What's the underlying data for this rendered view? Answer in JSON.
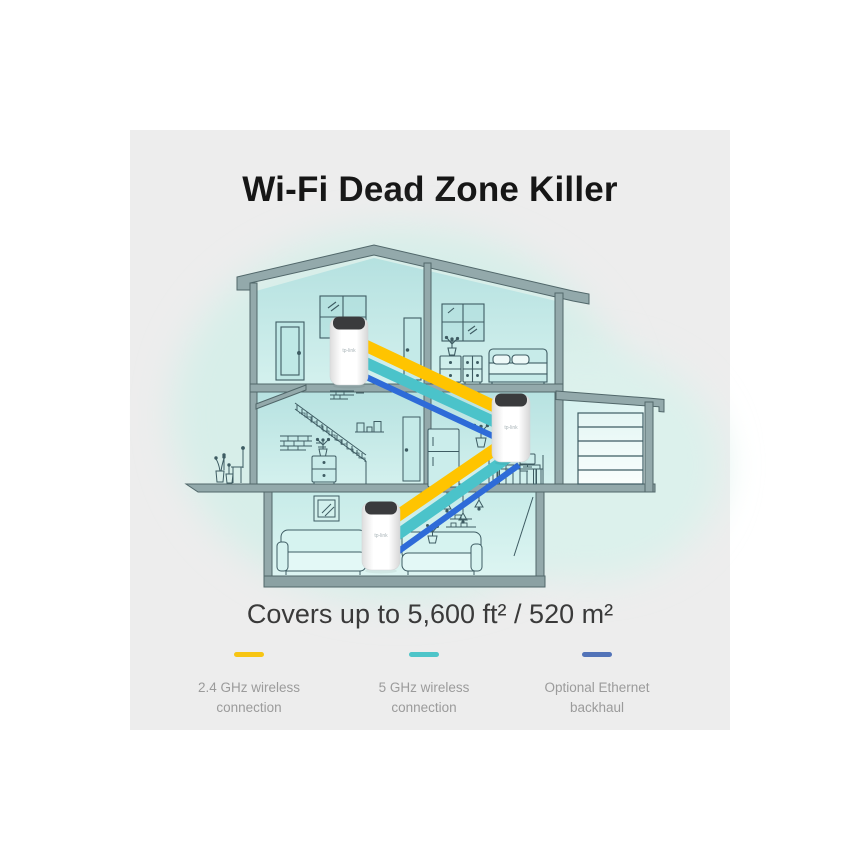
{
  "page": {
    "title": "Wi-Fi Dead Zone Killer",
    "coverage": "Covers up to 5,600 ft² / 520 m²"
  },
  "legend": {
    "items": [
      {
        "id": "wireless-24ghz",
        "line1": "2.4 GHz wireless",
        "line2": "connection",
        "color": "#F7C513"
      },
      {
        "id": "wireless-5ghz",
        "line1": "5 GHz wireless",
        "line2": "connection",
        "color": "#4EC5C9"
      },
      {
        "id": "ethernet-backhaul",
        "line1": "Optional Ethernet",
        "line2": "backhaul",
        "color": "#5273B8"
      }
    ]
  },
  "illustration": {
    "unit_logo": "tp-link",
    "unit_count": 3,
    "beam_colors": {
      "wireless_24ghz": "#FFC400",
      "wireless_5ghz": "#4BC3CA",
      "ethernet": "#2E6BD8"
    },
    "background_color": "#EDEDED",
    "blob_color": "#D7EEE9"
  }
}
